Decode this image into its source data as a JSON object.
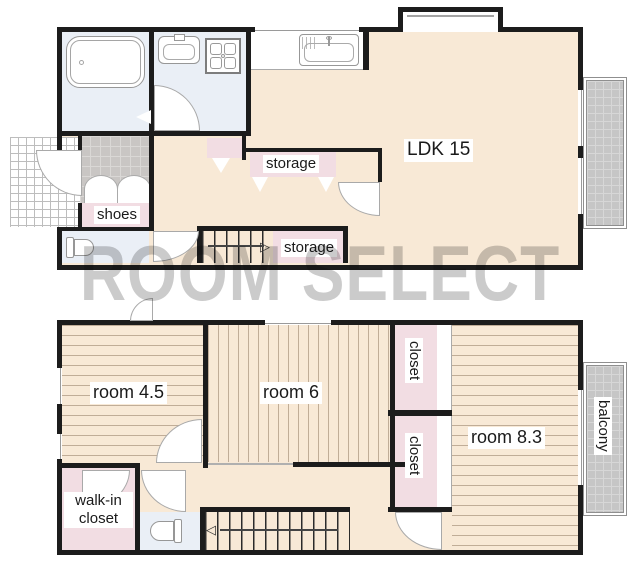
{
  "watermark": "ROOM SELECT",
  "palette": {
    "wall": "#1c1c1c",
    "floor_beige": "#f8e9d6",
    "closet_pink": "#f2dde3",
    "wet_area_blue": "#eaeff6",
    "tile_gray": "#c9c6c4",
    "balcony_gray": "#c6c6c6",
    "label_text": "#1a1a1a"
  },
  "floor1": {
    "labels": {
      "ldk": "LDK 15",
      "storage_upper": "storage",
      "storage_stairs": "storage",
      "shoes": "shoes"
    },
    "icons": {
      "stairs_up_arrow": "▷"
    }
  },
  "floor2": {
    "labels": {
      "room_small": "room 4.5",
      "room_mid": "room 6",
      "room_large": "room 8.3",
      "closet_upper": "closet",
      "closet_lower": "closet",
      "walk_in_closet": "walk-in closet",
      "balcony": "balcony"
    },
    "icons": {
      "stairs_down_arrow": "◁"
    }
  }
}
